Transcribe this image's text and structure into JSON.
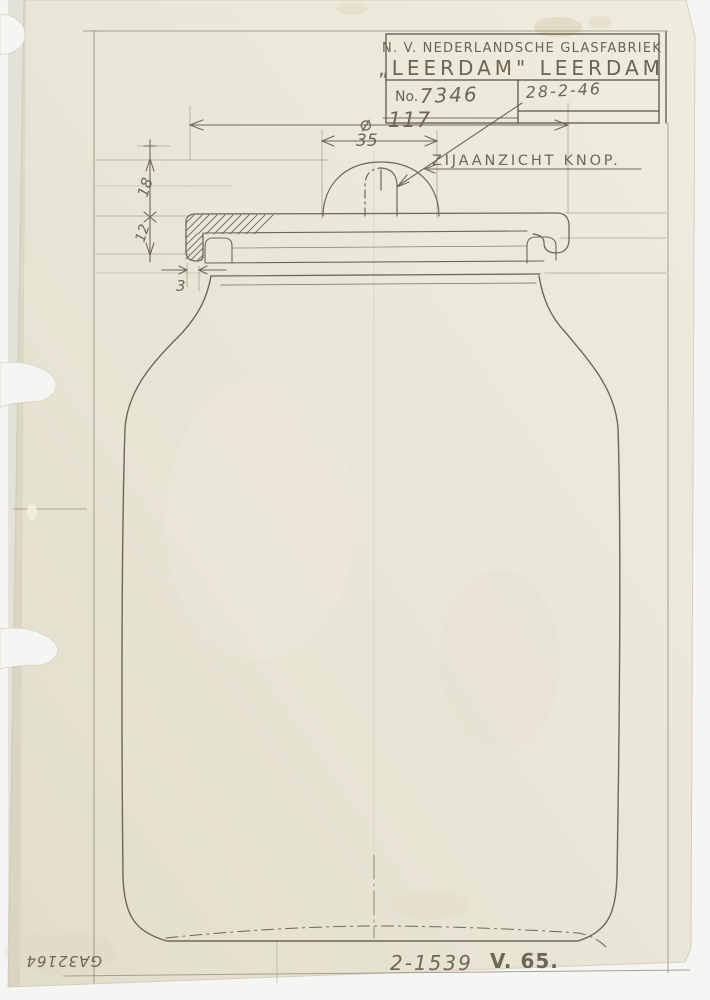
{
  "title_block": {
    "company_line1": "N. V. NEDERLANDSCHE GLASFABRIEK",
    "company_line2": "„LEERDAM\" LEERDAM",
    "no_label": "No.",
    "drawing_number": "7346",
    "date": "28-2-46"
  },
  "drawing": {
    "knob_view_label": "ZIJAANZICHT KNOP.",
    "dims": {
      "diameter_symbol": "⌀",
      "diameter": "117",
      "knob_width": "35",
      "lid_height": "18",
      "rim_height": "12",
      "clearance": "3"
    },
    "model_code": "2-1539",
    "variant_code": "V. 65.",
    "archive_number": "GA32164"
  },
  "colors": {
    "background": "#f5f6f4",
    "paper": "#e9e5d6",
    "pencil": "#6e6758",
    "pencil_dark": "#57513f",
    "pencil_light": "#aca490",
    "stain": "#d8cdb0"
  }
}
